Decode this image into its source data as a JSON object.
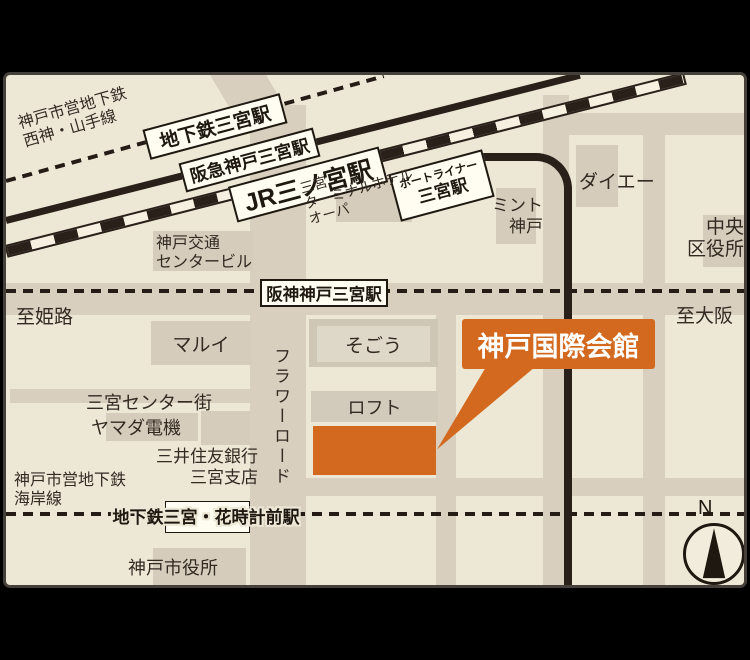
{
  "colors": {
    "highlight_orange": "#d2691e",
    "map_background": "#ede7d6",
    "road": "#d8cfbe",
    "rail_black": "#29201a",
    "frame_outer": "#000000"
  },
  "labels": {
    "subway_seishin_line1": "神戸市営地下鉄",
    "subway_seishin_line2": "西神・山手線",
    "sta_chikatetsu": "地下鉄三宮駅",
    "sta_hankyu": "阪急神戸三宮駅",
    "sta_jr": "JR三ノ宮駅",
    "sta_portliner_line1": "ポートライナー",
    "sta_portliner_line2": "三宮駅",
    "sta_hanshin": "阪神神戸三宮駅",
    "kotsu_center_line1": "神戸交通",
    "kotsu_center_line2": "センタービル",
    "terminal_hotel_line1": "三宮",
    "terminal_hotel_line2": "ターミナルホテル",
    "terminal_hotel_line3": "オーパ",
    "mint_line1": "ミント",
    "mint_line2": "神戸",
    "daiei": "ダイエー",
    "chuo_line1": "中央",
    "chuo_line2": "区役所",
    "to_himeji": "至姫路",
    "to_osaka": "至大阪",
    "marui": "マルイ",
    "sogo": "そごう",
    "loft": "ロフト",
    "center_gai": "三宮センター街",
    "yamada": "ヤマダ電機",
    "smbc_line1": "三井住友銀行",
    "smbc_line2": "三宮支店",
    "flower_road": "フラワーロード",
    "subway_kaigan_line1": "神戸市営地下鉄",
    "subway_kaigan_line2": "海岸線",
    "sta_hanadokei": "地下鉄三宮・花時計前駅",
    "city_hall": "神戸市役所",
    "callout": "神戸国際会館",
    "compass_north": "N"
  }
}
